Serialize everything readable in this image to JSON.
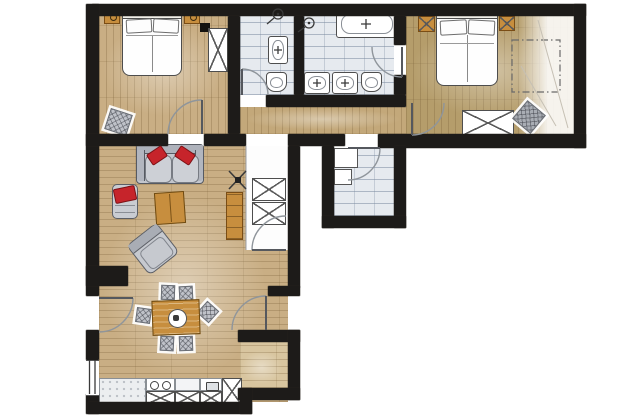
{
  "meta": {
    "label": "Hand-drawn watercolor apartment floor plan, L-shaped layout, no text labels"
  },
  "colors": {
    "wall": "#1d1b19",
    "wood_base": "#c9ae84",
    "wood_olive": "#b59d6b",
    "wood_pale": "#d8c59f",
    "wood_hall": "#c3a87a",
    "tile_base": "#e6eaef",
    "accent_red": "#c6242b",
    "furn_gray": "#bfc2c9",
    "furn_wood": "#c78e3e",
    "line": "#8f959b"
  },
  "rooms": [
    {
      "id": "bedroom-1",
      "floor": "wood",
      "items": [
        "double-bed",
        "nightstand",
        "nightstand",
        "wardrobe",
        "pouf",
        "wall-marker"
      ]
    },
    {
      "id": "shower-room",
      "floor": "tile",
      "items": [
        "shower-icon",
        "washbasin",
        "toilet"
      ]
    },
    {
      "id": "bathroom",
      "floor": "tile",
      "items": [
        "shower-icon",
        "bathtub",
        "double-washbasin",
        "toilet"
      ]
    },
    {
      "id": "bedroom-2",
      "floor": "wood",
      "items": [
        "double-bed",
        "nightstand",
        "nightstand",
        "wardrobe",
        "bean-bag",
        "planned-wardrobe-outline",
        "wall-marker"
      ]
    },
    {
      "id": "hallway",
      "floor": "wood",
      "items": []
    },
    {
      "id": "utility-room",
      "floor": "tile",
      "items": [
        "shelf-unit",
        "shelf-unit"
      ]
    },
    {
      "id": "entry-closet",
      "floor": "white",
      "items": [
        "wardrobe",
        "wardrobe"
      ]
    },
    {
      "id": "living-room",
      "floor": "wood",
      "items": [
        "sofa",
        "red-cushion",
        "red-cushion",
        "lounge-chair",
        "coffee-table",
        "armchair",
        "shelf-cabinet",
        "ceiling-fan-icon"
      ]
    },
    {
      "id": "dining-area",
      "floor": "wood",
      "items": [
        "dining-table",
        "dining-chair",
        "dining-chair",
        "dining-chair",
        "dining-chair",
        "dining-chair",
        "dining-chair"
      ]
    },
    {
      "id": "kitchen",
      "floor": "wood",
      "items": [
        "counter",
        "double-sink",
        "cooktop",
        "cabinet-x-front",
        "cabinet-x-front",
        "cabinet-x-front",
        "tall-cabinet"
      ]
    },
    {
      "id": "alcove",
      "floor": "wood",
      "items": []
    }
  ],
  "doors": [
    "bedroom-1-door",
    "shower-room-door",
    "bathroom-door",
    "bedroom-2-door",
    "utility-room-door",
    "entry-closet-door",
    "entrance-door",
    "balcony-door"
  ],
  "windows": [
    "left-window"
  ],
  "icons": [
    {
      "name": "shower-icon",
      "shape": "circle-with-hose"
    },
    {
      "name": "ceiling-fan-icon",
      "shape": "x-cross-with-square"
    },
    {
      "name": "faucet-icon",
      "shape": "plus-cross"
    }
  ]
}
